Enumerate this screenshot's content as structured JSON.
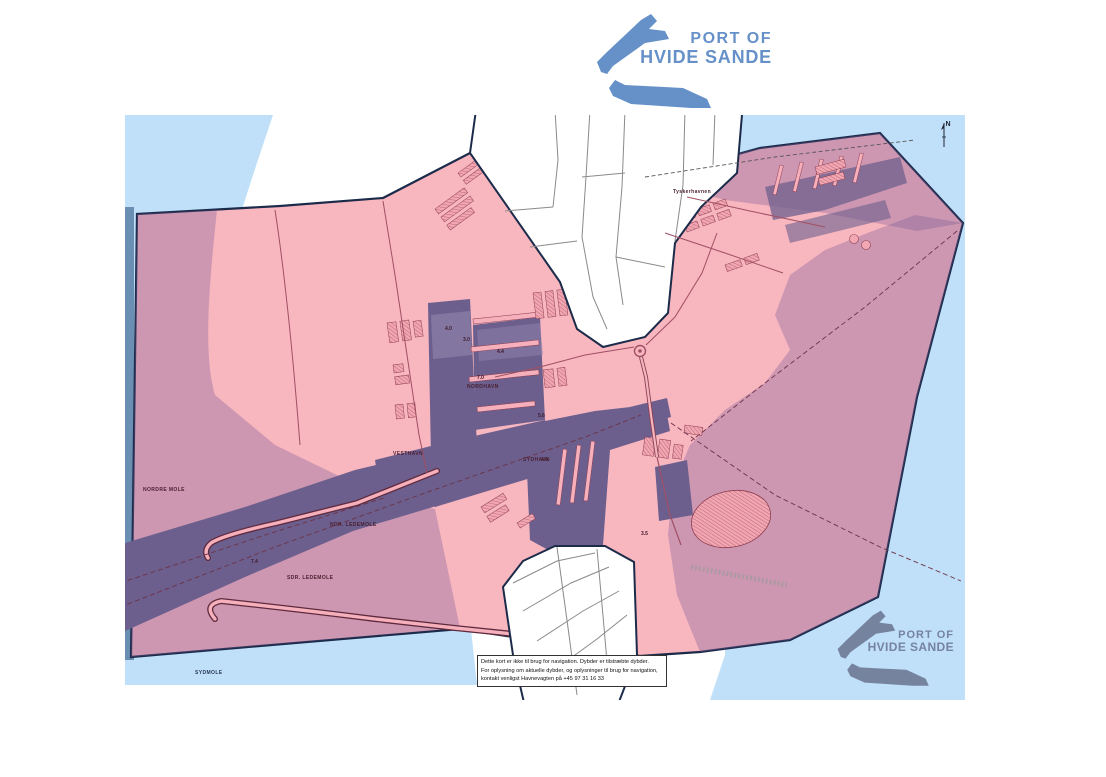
{
  "logo_top": {
    "line1": "PORT OF",
    "line2": "HVIDE SANDE"
  },
  "logo_bottom": {
    "line1": "PORT OF",
    "line2": "HVIDE SANDE"
  },
  "north_indicator": {
    "label": "N"
  },
  "disclaimer": {
    "line1": "Dette kort er ikke til brug for navigation. Dybder er tilstræbte dybder.",
    "line2": "For oplysning om aktuelle dybder, og oplysninger til brug for navigation,",
    "line3": "kontakt venligst Havnevagten på +45 97 31 16 33"
  },
  "map": {
    "labels": [
      {
        "text": "NORDRE MOLE"
      },
      {
        "text": "NDR. LEDEMOLE"
      },
      {
        "text": "SDR. LEDEMOLE"
      },
      {
        "text": "SYDMOLE"
      },
      {
        "text": "VESTHAVN"
      },
      {
        "text": "NORDHAVN"
      },
      {
        "text": "SYDHAVN"
      },
      {
        "text": "Tyskerhavnen"
      }
    ],
    "depths": [
      {
        "value": "4.0"
      },
      {
        "value": "3.0"
      },
      {
        "value": "4.4"
      },
      {
        "value": "7.0"
      },
      {
        "value": "5.6"
      },
      {
        "value": "7.4"
      },
      {
        "value": "4.0"
      },
      {
        "value": "3.5"
      }
    ],
    "colors": {
      "sea": "#bfe0f8",
      "land": "#f8b6bf",
      "port_water": "#c9a0b8",
      "channel": "#6c5f8d",
      "border": "#1c2b4a",
      "logo_blue": "#6590c8",
      "logo_slate": "#76839f"
    }
  }
}
